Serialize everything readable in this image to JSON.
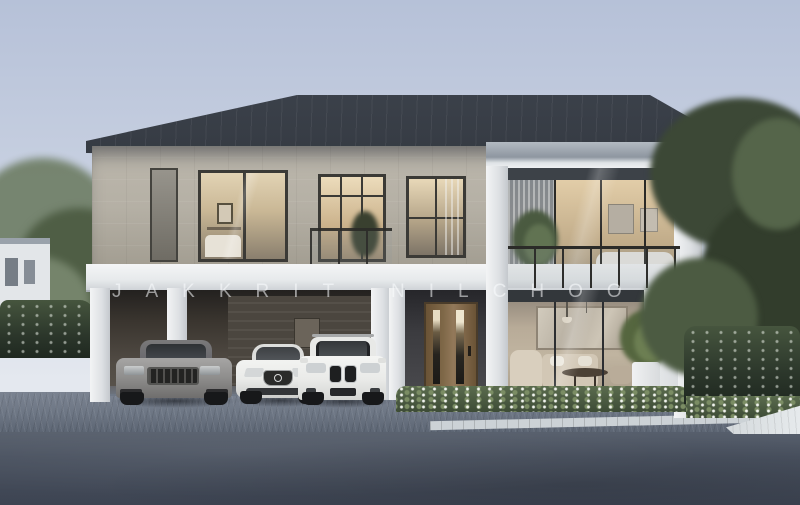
{
  "watermark": {
    "text": "JAKKRIT NILCHOO"
  },
  "colors": {
    "sky_top": "#b6c1d8",
    "sky_mid": "#ccd4e3",
    "sky_bottom": "#e4e8ef",
    "roof_light": "#434a54",
    "roof_dark": "#1d2026",
    "fascia": "#8e96a0",
    "stone": "#b5b0a5",
    "trim": "#eef0f2",
    "frame": "#3b3a36",
    "glass_warm": "#e6d6b6",
    "glass_dim": "#857c6d",
    "carport_wall": "#3a352f",
    "door_wood": "#7f6848",
    "interior_wall": "#b8ab98",
    "sofa": "#d2c7b5",
    "tree": "#4f5e45",
    "tree_dark": "#323d2c",
    "tree_light": "#72816a",
    "hedge": "#2c372b",
    "hedge_light": "#46553e",
    "grass": "#5b6c4e",
    "paver": "#6e7785",
    "road": "#49515f",
    "curb": "#ccd2d6",
    "car_silver": "#8f8e8d",
    "car_white": "#eaebe9",
    "tire": "#17181a"
  }
}
